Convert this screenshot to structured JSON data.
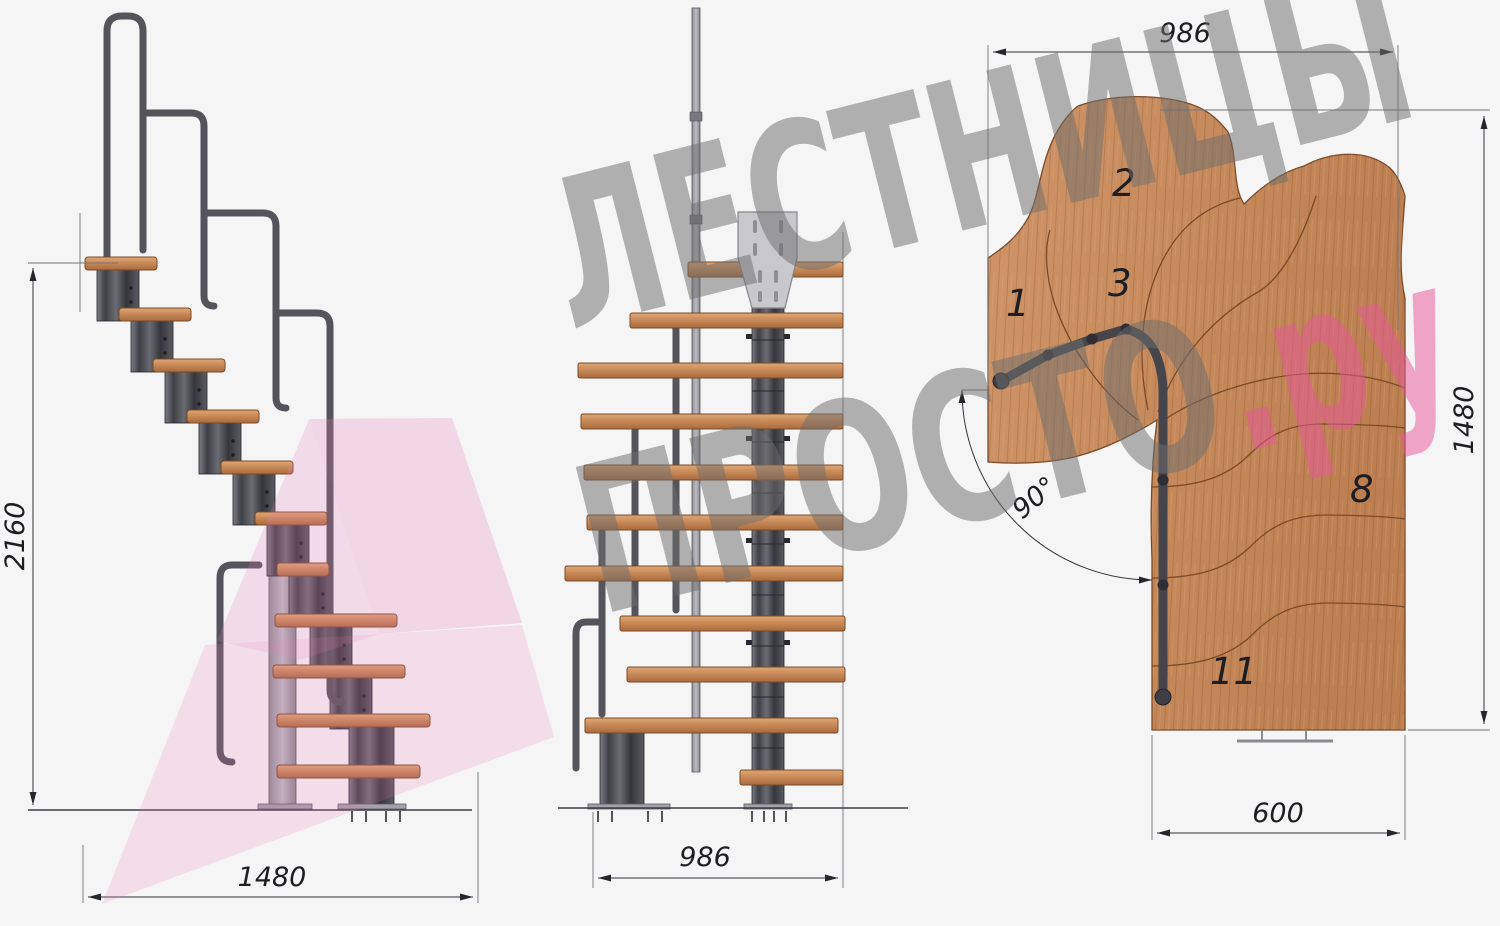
{
  "watermark": {
    "line1": "ЛЕСТНИЦЫ",
    "line2": "ПРОСТО",
    "suffix": ".ру"
  },
  "dims": {
    "side_height": "2160",
    "side_width": "1480",
    "front_width": "986",
    "plan_width": "986",
    "plan_depth": "1480",
    "plan_exit": "600",
    "plan_angle": "90°"
  },
  "plan_labels": [
    "1",
    "2",
    "3",
    "8",
    "11"
  ],
  "colors": {
    "background": "#f5f5f6",
    "wood": "#c98e60",
    "metal": "#47474d",
    "rail": "#54545a",
    "dimension_line": "#33333a",
    "watermark_gray": "#6f6f6f",
    "watermark_pink": "#e7589a",
    "ribbon_pink": "#e87fb8"
  }
}
